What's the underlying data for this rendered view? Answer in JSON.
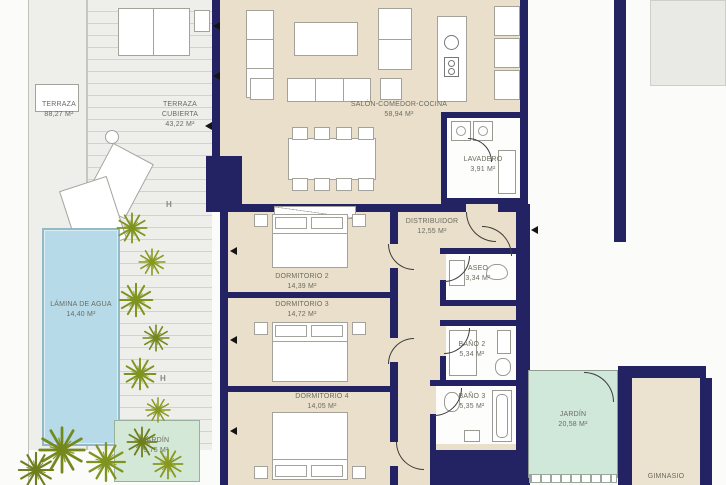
{
  "colors": {
    "wall": "#232364",
    "floor": "#eadfca",
    "terrace": "#eeeeea",
    "pool": "#b7dae8",
    "garden": "#cfe8da",
    "plant": "#7f941f",
    "label": "#6b6b60"
  },
  "rooms": {
    "terraza": {
      "name": "TERRAZA",
      "area": "88,27 m²"
    },
    "terraza_cubierta": {
      "name": "TERRAZA CUBIERTA",
      "area": "43,22 m²"
    },
    "salon": {
      "name": "SALÓN-COMEDOR-COCINA",
      "area": "58,94 m²"
    },
    "lavadero": {
      "name": "LAVADERO",
      "area": "3,91 m²"
    },
    "distribuidor": {
      "name": "DISTRIBUIDOR",
      "area": "12,55 m²"
    },
    "dorm2": {
      "name": "DORMITORIO 2",
      "area": "14,39 m²"
    },
    "dorm3": {
      "name": "DORMITORIO 3",
      "area": "14,72 m²"
    },
    "dorm4": {
      "name": "DORMITORIO 4",
      "area": "14,05 m²"
    },
    "aseo": {
      "name": "ASEO",
      "area": "3,34 m²"
    },
    "bano2": {
      "name": "BAÑO 2",
      "area": "5,34 m²"
    },
    "bano3": {
      "name": "BAÑO 3",
      "area": "5,35 m²"
    },
    "lamina": {
      "name": "LÁMINA DE AGUA",
      "area": "14,40 m²"
    },
    "jardin_left": {
      "name": "JARDÍN",
      "area": "9,75 m²"
    },
    "jardin": {
      "name": "JARDÍN",
      "area": "20,58 m²"
    },
    "gimnasio": {
      "name": "GIMNASIO",
      "area": ""
    }
  },
  "markers": {
    "h": "H"
  }
}
